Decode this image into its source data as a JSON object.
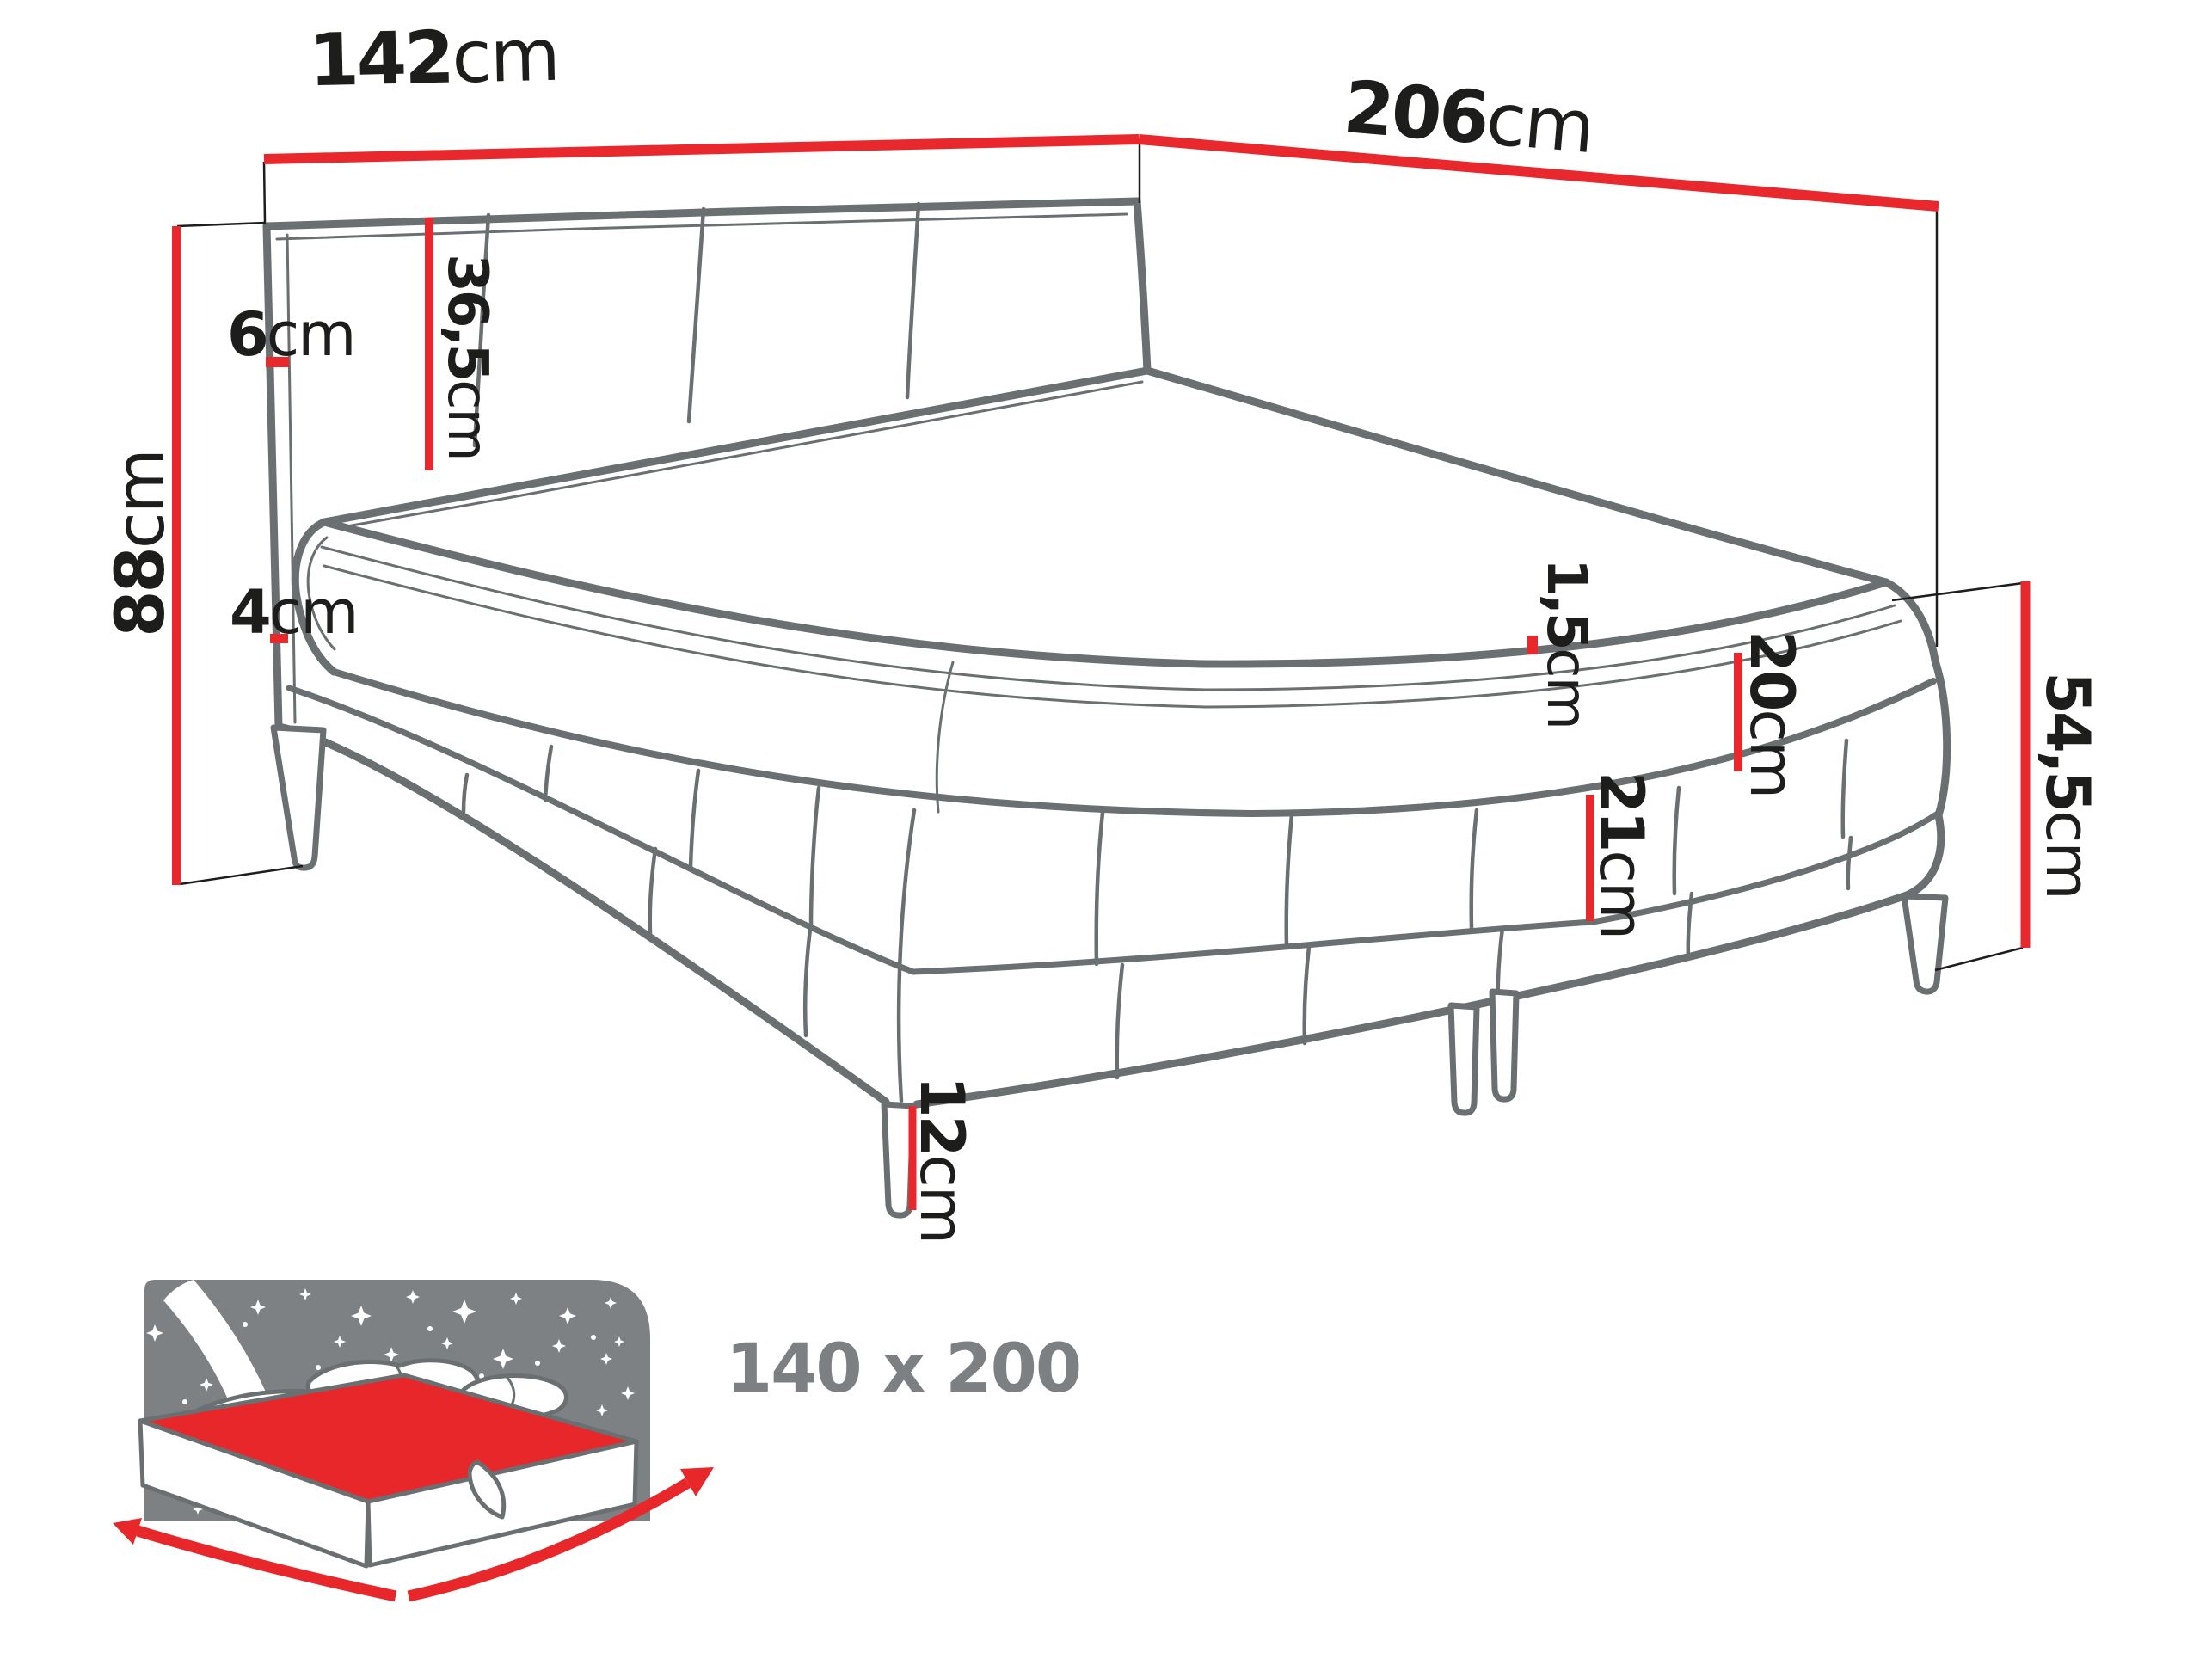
{
  "diagram": {
    "unit": "cm",
    "bed_size": "140 x 200",
    "dimensions": {
      "width": "142",
      "length": "206",
      "total_height": "88",
      "headboard_thickness": "6",
      "headboard_above_mattress": "36,5",
      "mattress_overhang": "4",
      "topper_thickness": "1,5",
      "mattress_height": "20",
      "base_height": "21",
      "leg_height": "12",
      "floor_to_mattress_top": "54,5"
    },
    "colors": {
      "accent_red": "#e8282c",
      "drawing_grey": "#6a6f71",
      "icon_grey": "#7d8184",
      "text_black": "#1d1d1b",
      "size_label_grey": "#7c8083"
    }
  }
}
